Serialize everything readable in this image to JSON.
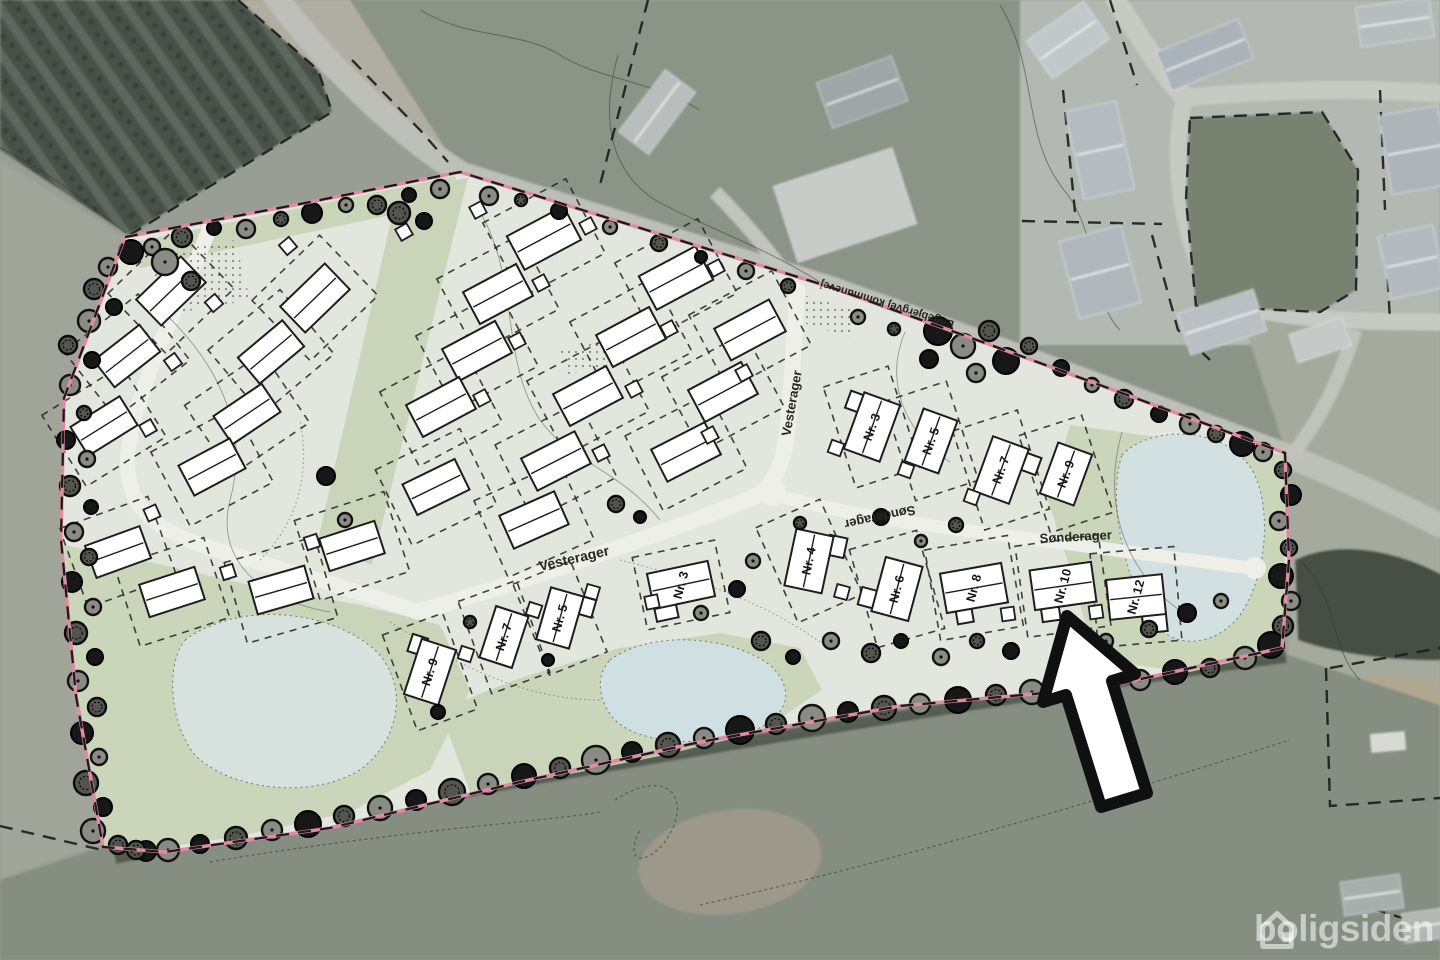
{
  "watermark": {
    "text": "boligsiden"
  },
  "map": {
    "colors": {
      "boundary_pink": "#e08ba4",
      "dash": "#1b1b1b",
      "house_fill": "#ffffff",
      "house_stroke": "#1d1d1d",
      "road": "#edefe8",
      "site": "#e3e6dc",
      "green": "#c7d3b6",
      "pond": "#d3e0e1",
      "tree_dark": "#171717",
      "tree_gray": "#8b8b85",
      "arrow_fill": "#ffffff",
      "arrow_stroke": "#101010",
      "label": "#26261f"
    },
    "street_labels": [
      {
        "text": "Vesterager",
        "x": 575,
        "y": 563,
        "rot": -13,
        "size": 14
      },
      {
        "text": "Vesterager",
        "x": 796,
        "y": 404,
        "rot": -80,
        "size": 13
      },
      {
        "text": "Sønderager",
        "x": 1076,
        "y": 541,
        "rot": -3,
        "size": 13
      },
      {
        "text": "Sønderager",
        "x": 879,
        "y": 513,
        "rot": 168,
        "size": 13
      },
      {
        "text": "Engebjergvej kommunevej",
        "x": 888,
        "y": 301,
        "rot": 197,
        "size": 11,
        "fill": "#3c3c34"
      }
    ],
    "houses": [
      {
        "x": 171,
        "y": 291,
        "r": -44,
        "w": 62,
        "h": 36
      },
      {
        "x": 127,
        "y": 356,
        "r": -38,
        "w": 58,
        "h": 34
      },
      {
        "x": 104,
        "y": 426,
        "r": -32,
        "w": 58,
        "h": 34
      },
      {
        "x": 118,
        "y": 552,
        "r": -20,
        "w": 58,
        "h": 34
      },
      {
        "x": 172,
        "y": 592,
        "r": -18,
        "w": 58,
        "h": 34
      },
      {
        "x": 315,
        "y": 298,
        "r": -44,
        "w": 62,
        "h": 36
      },
      {
        "x": 271,
        "y": 352,
        "r": -40,
        "w": 58,
        "h": 34
      },
      {
        "x": 247,
        "y": 414,
        "r": -34,
        "w": 58,
        "h": 34
      },
      {
        "x": 212,
        "y": 467,
        "r": -28,
        "w": 58,
        "h": 34
      },
      {
        "x": 281,
        "y": 590,
        "r": -16,
        "w": 58,
        "h": 34
      },
      {
        "x": 352,
        "y": 546,
        "r": -18,
        "w": 58,
        "h": 34
      },
      {
        "x": 544,
        "y": 238,
        "r": -28,
        "w": 64,
        "h": 38
      },
      {
        "x": 498,
        "y": 294,
        "r": -28,
        "w": 60,
        "h": 36
      },
      {
        "x": 477,
        "y": 351,
        "r": -28,
        "w": 60,
        "h": 36
      },
      {
        "x": 441,
        "y": 407,
        "r": -28,
        "w": 60,
        "h": 36
      },
      {
        "x": 436,
        "y": 487,
        "r": -26,
        "w": 58,
        "h": 34
      },
      {
        "x": 676,
        "y": 278,
        "r": -28,
        "w": 64,
        "h": 38
      },
      {
        "x": 631,
        "y": 337,
        "r": -28,
        "w": 60,
        "h": 36
      },
      {
        "x": 588,
        "y": 396,
        "r": -28,
        "w": 60,
        "h": 36
      },
      {
        "x": 556,
        "y": 461,
        "r": -27,
        "w": 60,
        "h": 36
      },
      {
        "x": 750,
        "y": 330,
        "r": -28,
        "w": 62,
        "h": 36
      },
      {
        "x": 723,
        "y": 392,
        "r": -28,
        "w": 60,
        "h": 36
      },
      {
        "x": 686,
        "y": 452,
        "r": -27,
        "w": 60,
        "h": 36
      },
      {
        "x": 534,
        "y": 520,
        "r": -24,
        "w": 60,
        "h": 36
      },
      {
        "x": 430,
        "y": 672,
        "r": -72,
        "w": 58,
        "h": 36,
        "label": "Nr. 9",
        "lr": -72,
        "lot": [
          64,
          102
        ],
        "lotR": -20,
        "wing": [
          22,
          -20,
          18,
          16
        ]
      },
      {
        "x": 504,
        "y": 637,
        "r": -72,
        "w": 54,
        "h": 34,
        "label": "Nr. 7",
        "lr": -72,
        "lot": [
          62,
          98
        ],
        "lotR": -20
      },
      {
        "x": 560,
        "y": 618,
        "r": -74,
        "w": 54,
        "h": 34,
        "label": "Nr. 5",
        "lr": -74,
        "lot": [
          62,
          98
        ],
        "lotR": -22,
        "wing": [
          18,
          22,
          18,
          16
        ]
      },
      {
        "x": 681,
        "y": 585,
        "r": -12,
        "w": 62,
        "h": 36,
        "label": "Nr. 3",
        "lr": -75,
        "lot": [
          84,
          74
        ],
        "lotR": -12,
        "wing": [
          -20,
          24,
          22,
          14
        ]
      },
      {
        "x": 872,
        "y": 427,
        "r": -70,
        "w": 60,
        "h": 38,
        "label": "Nr. 3",
        "lr": -70,
        "lot": [
          68,
          106
        ],
        "lotR": -18,
        "wing": [
          18,
          -24,
          18,
          16
        ]
      },
      {
        "x": 931,
        "y": 441,
        "r": -70,
        "w": 56,
        "h": 36,
        "label": "Nr. 5",
        "lr": -70,
        "lot": [
          66,
          104
        ],
        "lotR": -18
      },
      {
        "x": 1001,
        "y": 470,
        "r": -70,
        "w": 58,
        "h": 38,
        "label": "Nr. 7",
        "lr": -70,
        "lot": [
          68,
          104
        ],
        "lotR": -18,
        "wing": [
          16,
          26,
          18,
          16
        ]
      },
      {
        "x": 1066,
        "y": 474,
        "r": -70,
        "w": 54,
        "h": 36,
        "label": "Nr. 9",
        "lr": -70,
        "lot": [
          66,
          102
        ],
        "lotR": -18
      },
      {
        "x": 809,
        "y": 561,
        "r": -78,
        "w": 58,
        "h": 38,
        "label": "Nr. 4",
        "lr": -78,
        "lot": [
          70,
          104
        ],
        "lotR": -24,
        "wing": [
          20,
          24,
          20,
          18
        ]
      },
      {
        "x": 897,
        "y": 589,
        "r": -75,
        "w": 56,
        "h": 38,
        "label": "Nr. 6",
        "lr": -75,
        "lot": [
          70,
          102
        ],
        "lotR": -16,
        "wing": [
          -16,
          -26,
          18,
          16
        ]
      },
      {
        "x": 974,
        "y": 588,
        "r": -10,
        "w": 62,
        "h": 40,
        "label": "Nr. 8",
        "lr": -75,
        "lot": [
          84,
          92
        ],
        "lotR": -10,
        "wing": [
          -14,
          26,
          16,
          14
        ]
      },
      {
        "x": 1063,
        "y": 586,
        "r": -8,
        "w": 62,
        "h": 40,
        "label": "Nr. 10",
        "lr": -75,
        "lot": [
          84,
          92
        ],
        "lotR": -8,
        "wing": [
          -16,
          26,
          18,
          14
        ]
      },
      {
        "x": 1136,
        "y": 597,
        "r": -6,
        "w": 56,
        "h": 40,
        "label": "Nr. 12",
        "lr": -75,
        "lot": [
          84,
          94
        ],
        "lotR": -5,
        "wing": [
          16,
          28,
          24,
          18
        ]
      }
    ],
    "sheds": [
      [
        288,
        246,
        -40
      ],
      [
        214,
        303,
        -40
      ],
      [
        173,
        362,
        -36
      ],
      [
        148,
        428,
        -30
      ],
      [
        152,
        513,
        -24
      ],
      [
        228,
        572,
        -18
      ],
      [
        312,
        542,
        -18
      ],
      [
        588,
        226,
        -28
      ],
      [
        541,
        283,
        -28
      ],
      [
        517,
        341,
        -28
      ],
      [
        482,
        398,
        -28
      ],
      [
        716,
        268,
        -28
      ],
      [
        669,
        329,
        -28
      ],
      [
        634,
        389,
        -28
      ],
      [
        601,
        453,
        -27
      ],
      [
        744,
        373,
        -28
      ],
      [
        710,
        435,
        -28
      ],
      [
        836,
        448,
        -70
      ],
      [
        906,
        470,
        -70
      ],
      [
        972,
        497,
        -70
      ],
      [
        842,
        592,
        -75
      ],
      [
        1008,
        614,
        -8
      ],
      [
        1096,
        612,
        -8
      ],
      [
        466,
        654,
        -72
      ],
      [
        534,
        610,
        -72
      ],
      [
        592,
        592,
        -74
      ],
      [
        652,
        602,
        -12
      ],
      [
        404,
        232,
        -30
      ],
      [
        478,
        210,
        -28
      ]
    ],
    "trees": [
      [
        131,
        252,
        12
      ],
      [
        108,
        267,
        9
      ],
      [
        94,
        289,
        10
      ],
      [
        114,
        307,
        8
      ],
      [
        89,
        321,
        11
      ],
      [
        68,
        345,
        9
      ],
      [
        92,
        360,
        8
      ],
      [
        70,
        385,
        10
      ],
      [
        84,
        413,
        7
      ],
      [
        66,
        440,
        9
      ],
      [
        87,
        459,
        8
      ],
      [
        70,
        486,
        10
      ],
      [
        91,
        507,
        7
      ],
      [
        74,
        532,
        9
      ],
      [
        89,
        557,
        8
      ],
      [
        72,
        582,
        10
      ],
      [
        93,
        607,
        8
      ],
      [
        76,
        633,
        11
      ],
      [
        95,
        657,
        8
      ],
      [
        78,
        681,
        10
      ],
      [
        97,
        707,
        9
      ],
      [
        82,
        733,
        11
      ],
      [
        99,
        757,
        8
      ],
      [
        86,
        783,
        12
      ],
      [
        103,
        807,
        9
      ],
      [
        93,
        831,
        12
      ],
      [
        118,
        845,
        9
      ],
      [
        146,
        851,
        10
      ],
      [
        152,
        247,
        8
      ],
      [
        182,
        237,
        10
      ],
      [
        214,
        228,
        7
      ],
      [
        246,
        229,
        9
      ],
      [
        281,
        219,
        7
      ],
      [
        312,
        213,
        10
      ],
      [
        346,
        205,
        7
      ],
      [
        377,
        205,
        9
      ],
      [
        409,
        195,
        7
      ],
      [
        440,
        189,
        9
      ],
      [
        399,
        213,
        11
      ],
      [
        424,
        221,
        8
      ],
      [
        489,
        196,
        9
      ],
      [
        521,
        200,
        6
      ],
      [
        559,
        211,
        8
      ],
      [
        610,
        227,
        7
      ],
      [
        659,
        243,
        8
      ],
      [
        701,
        257,
        6
      ],
      [
        746,
        271,
        8
      ],
      [
        788,
        286,
        7
      ],
      [
        938,
        331,
        14
      ],
      [
        963,
        346,
        12
      ],
      [
        989,
        331,
        10
      ],
      [
        1006,
        361,
        13
      ],
      [
        976,
        373,
        9
      ],
      [
        1029,
        346,
        8
      ],
      [
        929,
        359,
        9
      ],
      [
        858,
        317,
        7
      ],
      [
        894,
        329,
        6
      ],
      [
        1061,
        368,
        8
      ],
      [
        1092,
        385,
        7
      ],
      [
        1124,
        399,
        9
      ],
      [
        1159,
        414,
        8
      ],
      [
        1190,
        424,
        10
      ],
      [
        1216,
        434,
        8
      ],
      [
        1242,
        444,
        12
      ],
      [
        1263,
        452,
        9
      ],
      [
        1283,
        470,
        8
      ],
      [
        1291,
        495,
        10
      ],
      [
        1279,
        521,
        9
      ],
      [
        1289,
        548,
        8
      ],
      [
        1281,
        576,
        12
      ],
      [
        1291,
        601,
        9
      ],
      [
        1283,
        626,
        10
      ],
      [
        1271,
        645,
        13
      ],
      [
        1245,
        658,
        11
      ],
      [
        1210,
        668,
        9
      ],
      [
        1175,
        672,
        12
      ],
      [
        1140,
        680,
        10
      ],
      [
        1105,
        685,
        13
      ],
      [
        1068,
        688,
        10
      ],
      [
        1032,
        692,
        12
      ],
      [
        996,
        695,
        10
      ],
      [
        958,
        700,
        13
      ],
      [
        920,
        704,
        10
      ],
      [
        884,
        708,
        12
      ],
      [
        848,
        712,
        10
      ],
      [
        812,
        718,
        13
      ],
      [
        776,
        724,
        10
      ],
      [
        740,
        730,
        14
      ],
      [
        704,
        738,
        10
      ],
      [
        668,
        745,
        12
      ],
      [
        632,
        752,
        10
      ],
      [
        596,
        760,
        14
      ],
      [
        560,
        768,
        10
      ],
      [
        524,
        776,
        12
      ],
      [
        488,
        784,
        10
      ],
      [
        452,
        792,
        13
      ],
      [
        416,
        800,
        10
      ],
      [
        380,
        808,
        12
      ],
      [
        344,
        816,
        10
      ],
      [
        308,
        824,
        13
      ],
      [
        272,
        830,
        10
      ],
      [
        236,
        838,
        11
      ],
      [
        200,
        844,
        9
      ],
      [
        168,
        850,
        11
      ],
      [
        136,
        850,
        9
      ],
      [
        326,
        476,
        9
      ],
      [
        345,
        520,
        7
      ],
      [
        616,
        504,
        8
      ],
      [
        640,
        517,
        6
      ],
      [
        753,
        561,
        7
      ],
      [
        800,
        523,
        6
      ],
      [
        881,
        517,
        8
      ],
      [
        921,
        541,
        6
      ],
      [
        956,
        525,
        7
      ],
      [
        737,
        589,
        8
      ],
      [
        701,
        613,
        7
      ],
      [
        761,
        641,
        9
      ],
      [
        793,
        657,
        7
      ],
      [
        831,
        641,
        8
      ],
      [
        871,
        653,
        9
      ],
      [
        901,
        641,
        7
      ],
      [
        941,
        657,
        8
      ],
      [
        977,
        641,
        7
      ],
      [
        1011,
        651,
        8
      ],
      [
        1106,
        641,
        7
      ],
      [
        1149,
        629,
        8
      ],
      [
        1187,
        613,
        9
      ],
      [
        1221,
        601,
        7
      ],
      [
        470,
        622,
        6
      ],
      [
        548,
        660,
        6
      ],
      [
        165,
        262,
        13
      ],
      [
        191,
        281,
        9
      ],
      [
        438,
        712,
        7
      ]
    ],
    "aerial_buildings": [
      [
        657,
        112,
        78,
        38,
        -53,
        "#b9bdbb",
        1
      ],
      [
        845,
        205,
        125,
        80,
        -18,
        "#c8cbc8",
        0
      ],
      [
        862,
        92,
        80,
        48,
        -20,
        "#9fa6a8",
        1
      ],
      [
        1068,
        40,
        70,
        46,
        -35,
        "#c2c7c9",
        1
      ],
      [
        1205,
        55,
        88,
        42,
        -22,
        "#aab3ba",
        1
      ],
      [
        1100,
        150,
        52,
        90,
        -12,
        "#b4bcc2",
        1
      ],
      [
        1395,
        22,
        74,
        40,
        -8,
        "#b7bcbe",
        1
      ],
      [
        1415,
        150,
        60,
        80,
        -10,
        "#adb5bb",
        1
      ],
      [
        1100,
        272,
        64,
        80,
        -15,
        "#b0b8be",
        1
      ],
      [
        1222,
        322,
        80,
        44,
        -18,
        "#b9c0c4",
        1
      ],
      [
        1320,
        340,
        56,
        30,
        -18,
        "#c6c9c7",
        0
      ],
      [
        1412,
        262,
        56,
        64,
        -12,
        "#b3bac0",
        1
      ],
      [
        1388,
        742,
        34,
        18,
        -5,
        "#d8d9d4",
        0
      ],
      [
        1372,
        895,
        60,
        34,
        -8,
        "#a8aeac",
        1
      ],
      [
        1428,
        925,
        50,
        30,
        -8,
        "#b4b8b4",
        1
      ]
    ],
    "arrow": {
      "points": "1067,616 1135,674 1112,681 1147,793 1101,807 1066,695 1043,702"
    }
  }
}
